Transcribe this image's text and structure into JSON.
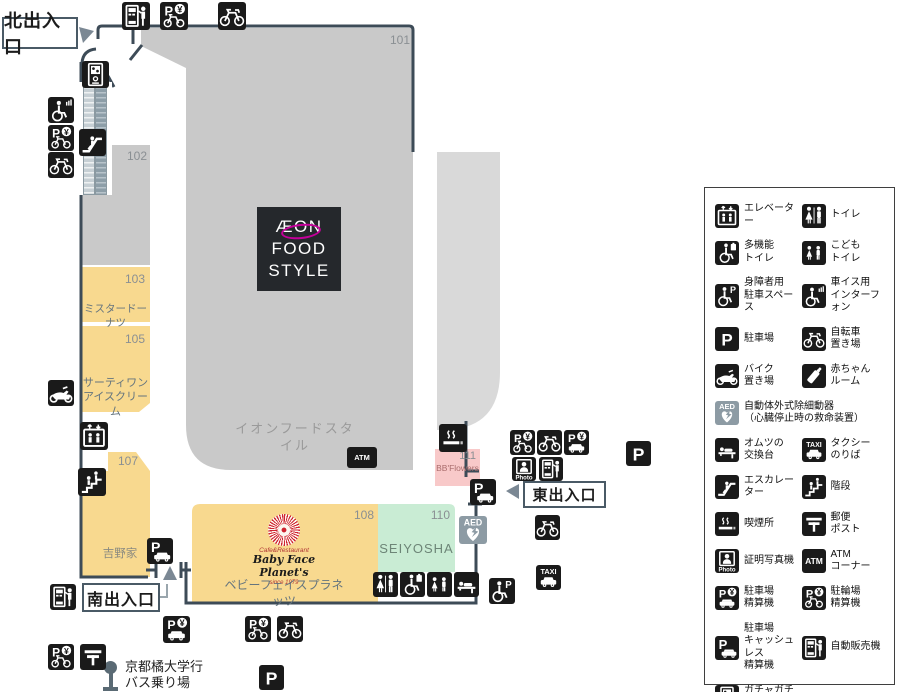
{
  "colors": {
    "wall": "#3d4b57",
    "area_gray": "#c9c9c9",
    "area_gray_light": "#d9d9d9",
    "area_tan": "#f8d98f",
    "area_green": "#c9ecd4",
    "area_pink": "#f8c9c9",
    "icon_black": "#1a1a1a",
    "aed_gray": "#8d9ba4",
    "aeon_magenta": "#c4009a",
    "babyface_red": "#cf2430",
    "arrow_gray": "#7b8894",
    "bus_marker": "#5a6a74"
  },
  "entrances": {
    "north": "北出入口",
    "south": "南出入口",
    "east": "東出入口"
  },
  "areas": {
    "a101": {
      "number": "101",
      "name": "イオンフードスタイル"
    },
    "a102": {
      "number": "102"
    },
    "a103": {
      "number": "103",
      "name": "ミスタードーナツ"
    },
    "a105": {
      "number": "105",
      "name": "サーティワン\nアイスクリーム"
    },
    "a107": {
      "number": "107",
      "name": "吉野家"
    },
    "a108": {
      "number": "108",
      "name": "ベビーフェイスプラネッツ",
      "logo_top": "Cafe&Restaurant",
      "logo_main": "Baby Face Planet's",
      "logo_sub": "since 1979"
    },
    "a110": {
      "number": "110",
      "name": "SEIYOSHA"
    },
    "a111": {
      "number": "111",
      "name": "BB'Flowers"
    }
  },
  "aeon_logo": {
    "line1": "ÆON",
    "line2": "FOOD",
    "line3": "STYLE"
  },
  "bus_stop": {
    "line1": "京都橘大学行",
    "line2": "バス乗り場"
  },
  "legend": {
    "items": [
      {
        "icon": "elevator",
        "label": "エレベーター"
      },
      {
        "icon": "toilet",
        "label": "トイレ"
      },
      {
        "icon": "multitoilet",
        "label": "多機能\nトイレ"
      },
      {
        "icon": "kidstoilet",
        "label": "こども\nトイレ"
      },
      {
        "icon": "handicap-parking",
        "label": "身障者用\n駐車スペース"
      },
      {
        "icon": "wheelchair-intercom",
        "label": "車イス用\nインターフォン"
      },
      {
        "icon": "parking",
        "label": "駐車場"
      },
      {
        "icon": "bicycle",
        "label": "自転車\n置き場"
      },
      {
        "icon": "motorcycle",
        "label": "バイク\n置き場"
      },
      {
        "icon": "babyroom",
        "label": "赤ちゃん\nルーム"
      },
      {
        "icon": "aed",
        "label": "自動体外式除細動器\n（心臓停止時の救命装置）",
        "wide": true
      },
      {
        "icon": "diaper",
        "label": "オムツの\n交換台"
      },
      {
        "icon": "taxi",
        "label": "タクシー\nのりば"
      },
      {
        "icon": "escalator",
        "label": "エスカレーター"
      },
      {
        "icon": "stairs",
        "label": "階段"
      },
      {
        "icon": "smoking",
        "label": "喫煙所"
      },
      {
        "icon": "post",
        "label": "郵便\nポスト"
      },
      {
        "icon": "photo",
        "label": "証明写真機"
      },
      {
        "icon": "atm",
        "label": "ATM\nコーナー"
      },
      {
        "icon": "parking-pay",
        "label": "駐車場\n精算機"
      },
      {
        "icon": "bicycle-pay",
        "label": "駐輪場\n精算機"
      },
      {
        "icon": "parking-cashless",
        "label": "駐車場\nキャッシュレス\n精算機"
      },
      {
        "icon": "vending",
        "label": "自動販売機"
      },
      {
        "icon": "gacha",
        "label": "ガチャガチャ"
      }
    ]
  },
  "map_icons": [
    {
      "icon": "vending",
      "x": 122,
      "y": 2,
      "s": 28
    },
    {
      "icon": "bicycle-pay",
      "x": 160,
      "y": 2,
      "s": 28
    },
    {
      "icon": "bicycle",
      "x": 218,
      "y": 2,
      "s": 28
    },
    {
      "icon": "gacha",
      "x": 82,
      "y": 61,
      "s": 27
    },
    {
      "icon": "wheelchair-intercom",
      "x": 48,
      "y": 97,
      "s": 26
    },
    {
      "icon": "bicycle-pay",
      "x": 48,
      "y": 125,
      "s": 26
    },
    {
      "icon": "bicycle",
      "x": 48,
      "y": 152,
      "s": 26
    },
    {
      "icon": "escalator",
      "x": 79,
      "y": 129,
      "s": 27
    },
    {
      "icon": "motorcycle",
      "x": 48,
      "y": 380,
      "s": 26
    },
    {
      "icon": "elevator",
      "x": 80,
      "y": 422,
      "s": 28
    },
    {
      "icon": "stairs",
      "x": 78,
      "y": 468,
      "s": 28
    },
    {
      "icon": "parking-cashless",
      "x": 147,
      "y": 538,
      "s": 26
    },
    {
      "icon": "vending",
      "x": 50,
      "y": 584,
      "s": 26
    },
    {
      "icon": "parking-pay",
      "x": 163,
      "y": 616,
      "s": 27
    },
    {
      "icon": "bicycle-pay",
      "x": 245,
      "y": 616,
      "s": 26
    },
    {
      "icon": "bicycle",
      "x": 277,
      "y": 616,
      "s": 26
    },
    {
      "icon": "bicycle-pay",
      "x": 48,
      "y": 644,
      "s": 26
    },
    {
      "icon": "post",
      "x": 80,
      "y": 644,
      "s": 26
    },
    {
      "icon": "parking",
      "x": 259,
      "y": 665,
      "s": 25
    },
    {
      "icon": "atm",
      "x": 347,
      "y": 447,
      "w": 30,
      "h": 21
    },
    {
      "icon": "smoking",
      "x": 439,
      "y": 424,
      "s": 28
    },
    {
      "icon": "parking-cashless",
      "x": 470,
      "y": 479,
      "s": 26
    },
    {
      "icon": "aed",
      "x": 459,
      "y": 516,
      "s": 28
    },
    {
      "icon": "bicycle-pay",
      "x": 510,
      "y": 430,
      "s": 25
    },
    {
      "icon": "bicycle",
      "x": 537,
      "y": 430,
      "s": 25
    },
    {
      "icon": "parking-pay",
      "x": 564,
      "y": 430,
      "s": 25
    },
    {
      "icon": "photo",
      "x": 512,
      "y": 457,
      "s": 24
    },
    {
      "icon": "vending",
      "x": 539,
      "y": 457,
      "s": 24
    },
    {
      "icon": "parking",
      "x": 626,
      "y": 441,
      "s": 25
    },
    {
      "icon": "bicycle",
      "x": 535,
      "y": 515,
      "s": 25
    },
    {
      "icon": "toilet",
      "x": 373,
      "y": 572,
      "s": 25
    },
    {
      "icon": "multitoilet",
      "x": 400,
      "y": 572,
      "s": 25
    },
    {
      "icon": "kidstoilet",
      "x": 427,
      "y": 572,
      "s": 25
    },
    {
      "icon": "diaper",
      "x": 454,
      "y": 572,
      "s": 25
    },
    {
      "icon": "handicap-parking",
      "x": 489,
      "y": 578,
      "s": 26
    },
    {
      "icon": "taxi",
      "x": 536,
      "y": 565,
      "s": 25
    }
  ]
}
